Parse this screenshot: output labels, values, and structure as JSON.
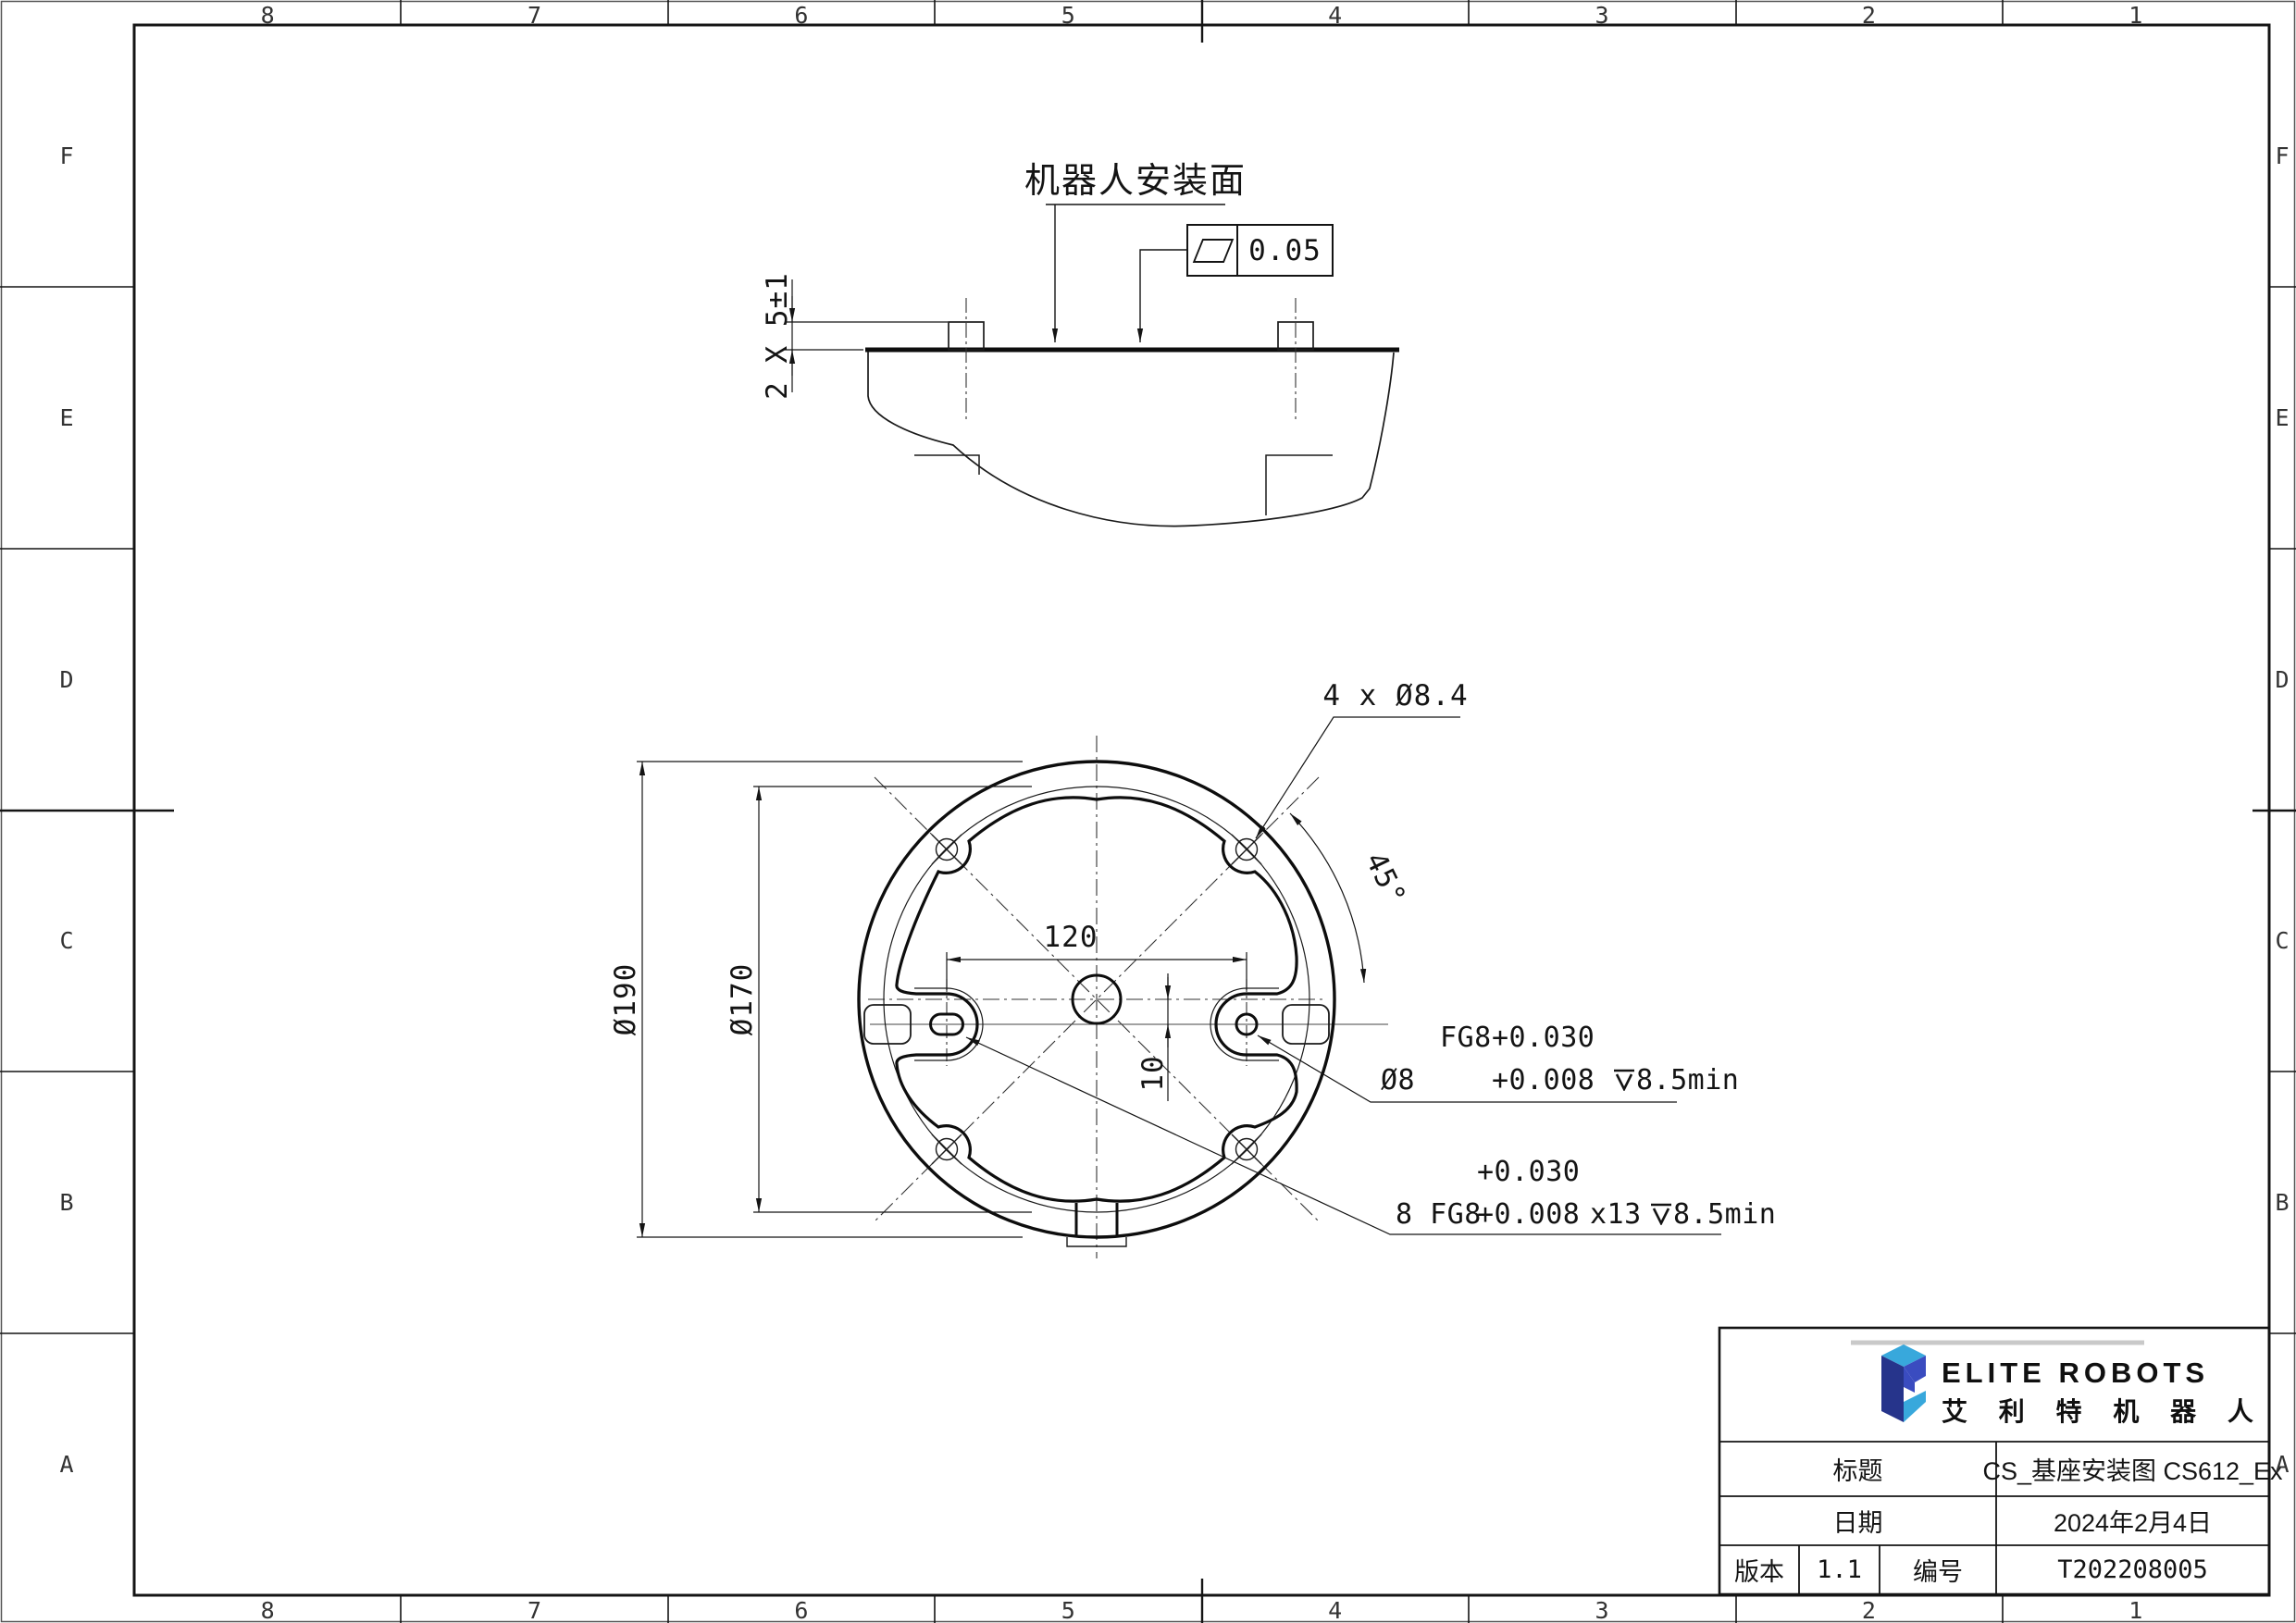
{
  "sheet": {
    "zones": {
      "cols": [
        "8",
        "7",
        "6",
        "5",
        "4",
        "3",
        "2",
        "1"
      ],
      "rows": [
        "F",
        "E",
        "D",
        "C",
        "B",
        "A"
      ]
    }
  },
  "colors": {
    "line": "#141414",
    "accent_gray": "#c9c9c9",
    "logo_navy": "#26348B",
    "logo_royal": "#3A4CC0",
    "logo_cyan": "#38A8DC"
  },
  "side_view": {
    "surface_label": "机器人安装面",
    "flatness_value": "0.05",
    "pin_height_dim": "2 X 5±1"
  },
  "plan_view": {
    "holes_dim": "4 x Ø8.4",
    "angle_dim": "45°",
    "bolt_span_dim": "120",
    "pin_offset_dim": "10",
    "outer_dia_dim": "Ø190",
    "bolt_circle_dim": "Ø170"
  },
  "annotations": {
    "pin_hole": {
      "prefix": "Ø8",
      "fit": "FG8",
      "tol_up": "+0.030",
      "tol_low": "+0.008",
      "depth": "8.5min"
    },
    "slot_hole": {
      "prefix": "8 FG8",
      "tol_up": "+0.030",
      "tol_low": "+0.008",
      "mult": "x13",
      "depth": "8.5min"
    }
  },
  "title_block": {
    "logo_en": "ELITE ROBOTS",
    "logo_cn": "艾 利 特 机 器 人",
    "title_label": "标题",
    "title_value": "CS_基座安装图 CS612_Ex",
    "date_label": "日期",
    "date_value": "2024年2月4日",
    "version_label": "版本",
    "version_value": "1.1",
    "number_label": "编号",
    "number_value": "T202208005"
  }
}
